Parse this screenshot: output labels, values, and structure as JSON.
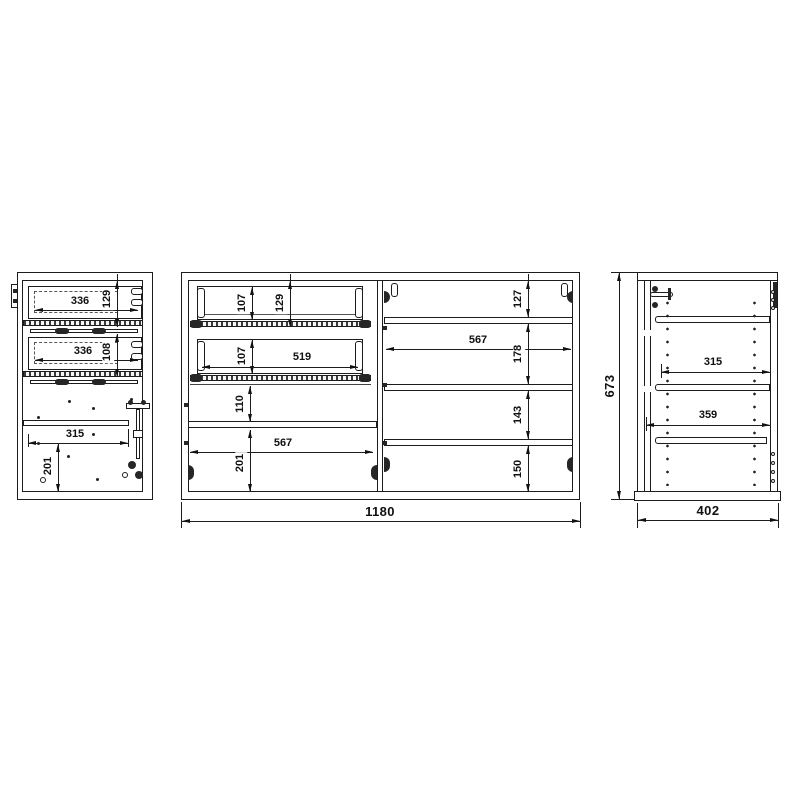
{
  "palette": {
    "line": "#1c1c1c",
    "background": "#ffffff",
    "text": "#101010"
  },
  "views": {
    "left_cabinet_front": {
      "dims": {
        "drawer1_width": "336",
        "drawer1_height": "129",
        "drawer2_width": "336",
        "drawer2_height": "108",
        "shelf_width": "315",
        "bottom_height": "201"
      }
    },
    "center_cabinet_front": {
      "dims": {
        "drawer1_box_height": "107",
        "drawer1_front_height": "129",
        "drawer2_box_height": "107",
        "drawer2_width": "519",
        "gap_below_drawers": "110",
        "left_shelf_width": "567",
        "left_bottom_height": "201",
        "right_top_gap": "127",
        "right_shelf_width": "567",
        "right_gap_upper": "178",
        "right_gap_middle": "143",
        "right_gap_lower": "150",
        "overall_width": "1180"
      }
    },
    "side_section": {
      "dims": {
        "overall_height": "673",
        "overall_depth": "402",
        "upper_shelf_depth": "315",
        "lower_shelf_depth": "359"
      }
    }
  }
}
